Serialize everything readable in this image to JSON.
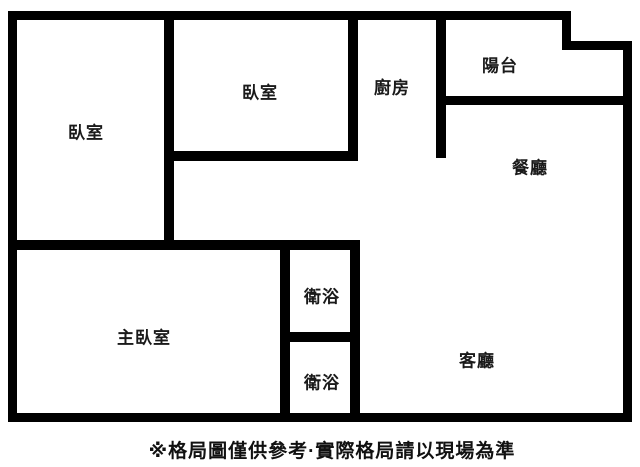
{
  "rooms": {
    "bedroom_left": "臥室",
    "bedroom_top": "臥室",
    "kitchen": "廚房",
    "balcony": "陽台",
    "dining": "餐廳",
    "master_bedroom": "主臥室",
    "bathroom_upper": "衛浴",
    "bathroom_lower": "衛浴",
    "living": "客廳"
  },
  "footer": {
    "disclaimer": "※格局圖僅供參考·實際格局請以現場為準"
  },
  "colors": {
    "wall": "#000000",
    "background": "#ffffff",
    "label_text": "#1a1a1a"
  }
}
